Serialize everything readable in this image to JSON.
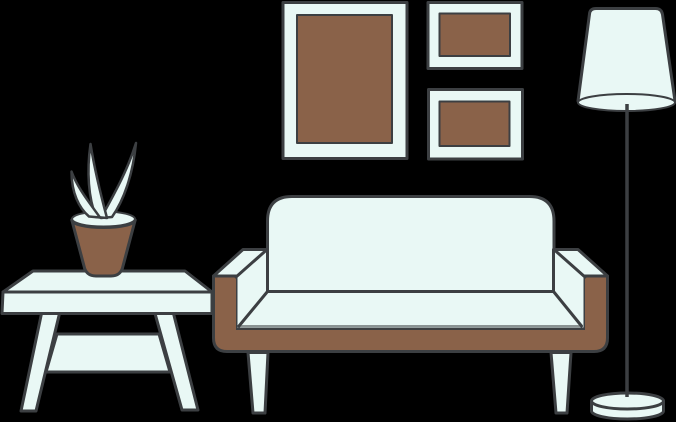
{
  "scene": {
    "label": "Flat illustration of a living room with sofa, coffee table, potted plant, wall frames and floor lamp",
    "background": "#000000"
  },
  "colors": {
    "background": "#000000",
    "outline": "#3c3f42",
    "light": "#e9f8f5",
    "brown": "#8a6249"
  },
  "objects": {
    "wall_frames": {
      "count": 3,
      "large_frame": {
        "orientation": "portrait",
        "mat_color": "light",
        "artwork_color": "brown"
      },
      "small_frame_top": {
        "orientation": "landscape",
        "mat_color": "light",
        "artwork_color": "brown"
      },
      "small_frame_bottom": {
        "orientation": "landscape",
        "mat_color": "light",
        "artwork_color": "brown"
      }
    },
    "floor_lamp": {
      "shade": "tapered drum shade, light fill",
      "pole": "thin dark pole",
      "base": "round disc base, light fill"
    },
    "sofa": {
      "backrest": "rounded rectangle cushion, light fill",
      "armrests": "boxy armrests with light top bevel",
      "frame": "brown wooden U-shaped frame",
      "legs": 2,
      "leg_style": "tapered light legs"
    },
    "coffee_table": {
      "top": "light slab with perspective top face",
      "legs": 2,
      "leg_style": "splayed tapered legs",
      "shelf": "lower stretcher shelf"
    },
    "potted_plant": {
      "pot_color": "brown",
      "pot_rim": "light ellipse rim",
      "leaves": 3,
      "leaf_color": "light"
    }
  }
}
